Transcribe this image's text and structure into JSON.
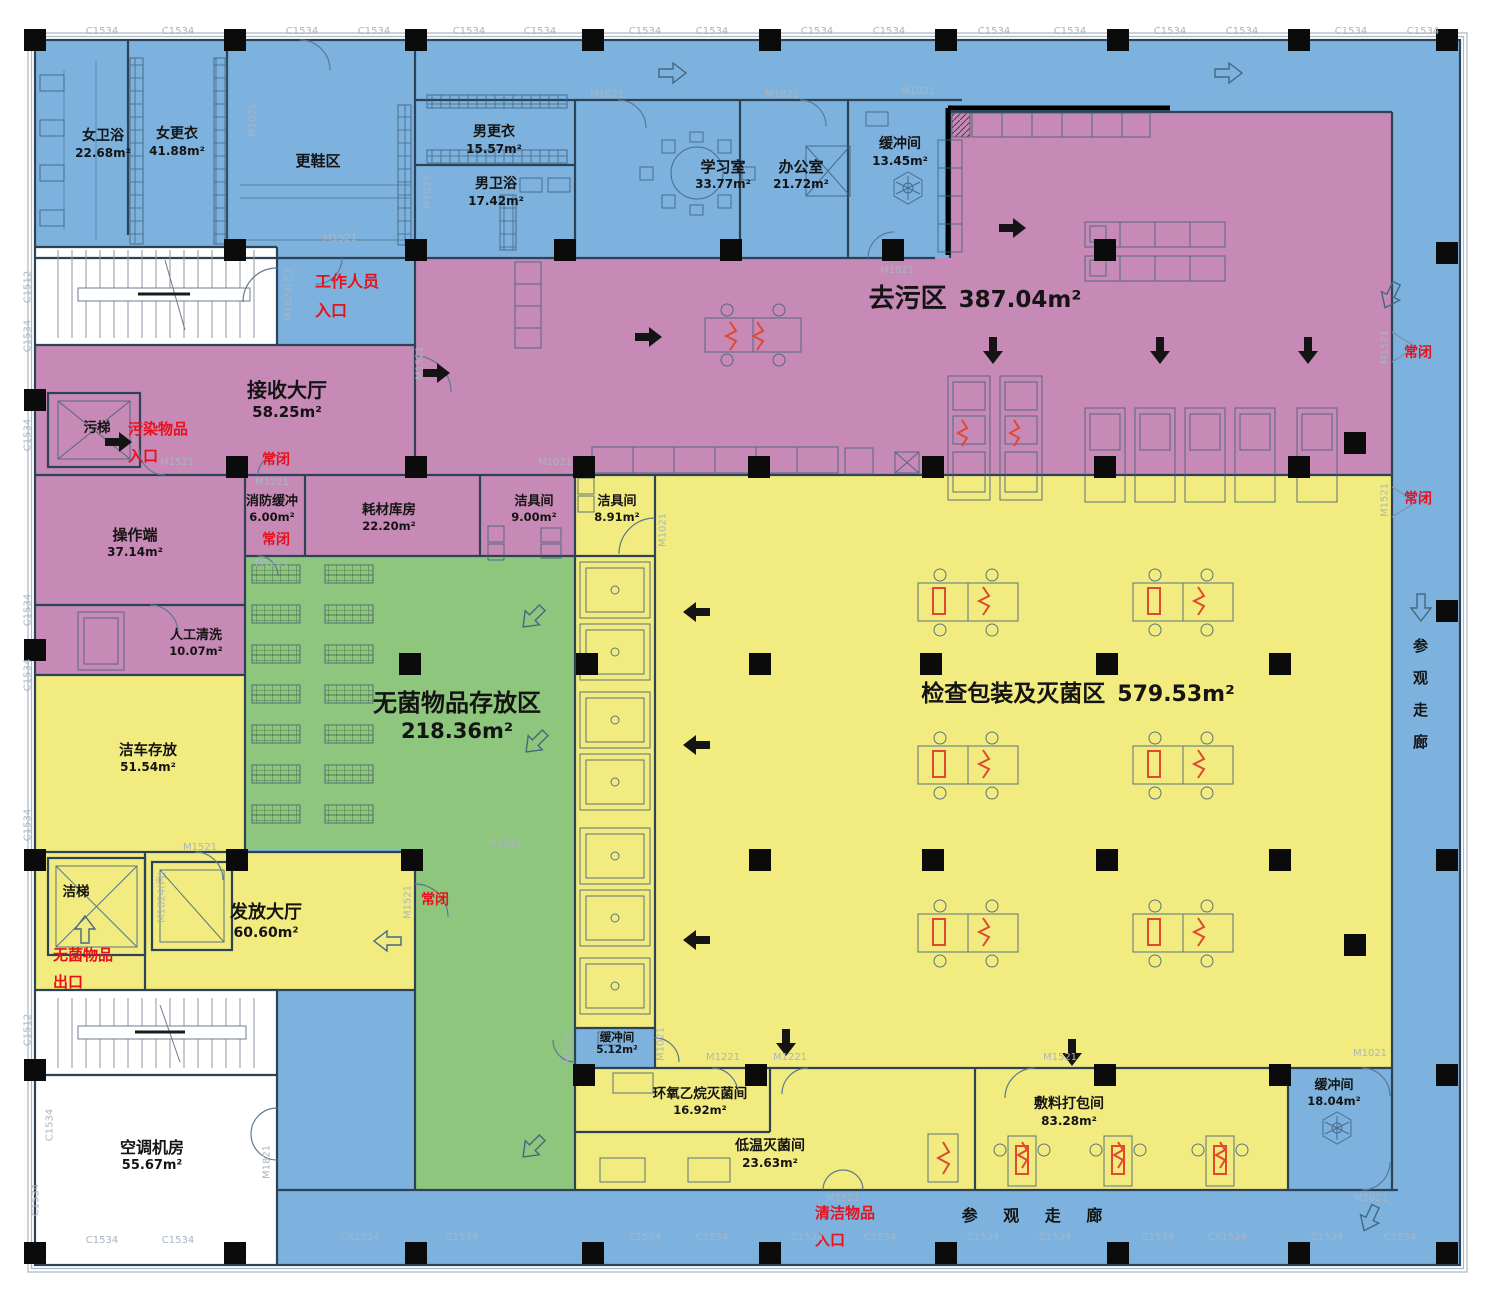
{
  "colors": {
    "zone_blue": "#7cb2dd",
    "zone_pink": "#c789b5",
    "zone_yellow": "#f2ec80",
    "zone_green": "#8ec67d",
    "wall": "#2c4257",
    "red_note": "#e8101d",
    "code_gray": "#a9b5c2",
    "column_black": "#0b0b0b",
    "equipment_red": "#e2482e"
  },
  "zones": {
    "quwu": {
      "name": "去污区",
      "area": "387.04m²"
    },
    "wujun_cunfang": {
      "name": "无菌物品存放区",
      "area": "218.36m²"
    },
    "jiancha": {
      "name": "检查包装及灭菌区",
      "area": "579.53m²"
    }
  },
  "rooms": {
    "nv_weiyu": {
      "name": "女卫浴",
      "area": "22.68m²"
    },
    "nv_gengyi": {
      "name": "女更衣",
      "area": "41.88m²"
    },
    "gengxie": {
      "name": "更鞋区"
    },
    "nan_gengyi": {
      "name": "男更衣",
      "area": "15.57m²"
    },
    "nan_weiyu": {
      "name": "男卫浴",
      "area": "17.42m²"
    },
    "xuexi": {
      "name": "学习室",
      "area": "33.77m²"
    },
    "bangong": {
      "name": "办公室",
      "area": "21.72m²"
    },
    "huanchong_a": {
      "name": "缓冲间",
      "area": "13.45m²"
    },
    "jieshou": {
      "name": "接收大厅",
      "area": "58.25m²"
    },
    "wuti": {
      "name": "污梯"
    },
    "caozuoduan": {
      "name": "操作端",
      "area": "37.14m²"
    },
    "rengong_qingxi": {
      "name": "人工清洗",
      "area": "10.07m²"
    },
    "xiaofang": {
      "name": "消防缓冲",
      "area": "6.00m²"
    },
    "haocai": {
      "name": "耗材库房",
      "area": "22.20m²"
    },
    "jieju_a": {
      "name": "洁具间",
      "area": "9.00m²"
    },
    "jieju_b": {
      "name": "洁具间",
      "area": "8.91m²"
    },
    "jieche": {
      "name": "洁车存放",
      "area": "51.54m²"
    },
    "jieti": {
      "name": "洁梯"
    },
    "fafang": {
      "name": "发放大厅",
      "area": "60.60m²"
    },
    "huanchong_b": {
      "name": "缓冲间",
      "area": "5.12m²"
    },
    "kongtiao": {
      "name": "空调机房",
      "area": "55.67m²"
    },
    "huanyang": {
      "name": "环氧乙烷灭菌间",
      "area": "16.92m²"
    },
    "diwen": {
      "name": "低温灭菌间",
      "area": "23.63m²"
    },
    "fuliao": {
      "name": "敷料打包间",
      "area": "83.28m²"
    },
    "huanchong_c": {
      "name": "缓冲间",
      "area": "18.04m²"
    }
  },
  "corridors": {
    "visit_bottom": "参  观  走  廊",
    "visit_right": "参观走廊"
  },
  "red_notes": {
    "staff_line1": "工作人员",
    "staff_line2": "入口",
    "dirty_line1": "污染物品",
    "dirty_line2": "入口",
    "sterile_line1": "无菌物品",
    "sterile_line2": "出口",
    "clean_line1": "清洁物品",
    "clean_line2": "入口",
    "normally_closed": "常闭"
  },
  "codes": {
    "c1534": "C1534",
    "c1512": "C1512",
    "cx1534": "CX1534",
    "m1021": "M1021",
    "m1521": "M1521",
    "m1221": "M1221",
    "m1824b": "M1824(乙)",
    "m1824c": "M1824(丙)",
    "m1821": "M1821"
  }
}
